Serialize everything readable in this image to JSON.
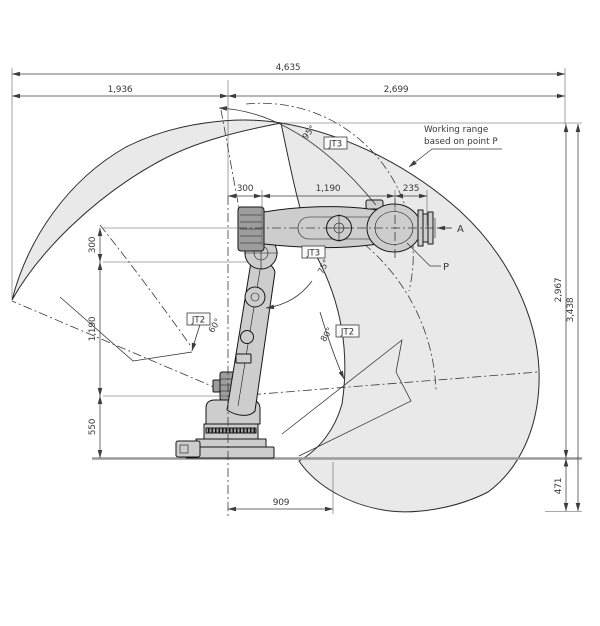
{
  "drawing": {
    "note_line1": "Working range",
    "note_line2": "based on point P",
    "point_a": "A",
    "point_p": "P"
  },
  "joints": {
    "jt3_top": "JT3",
    "jt3_mid": "JT3",
    "jt2_left": "JT2",
    "jt2_right": "JT2"
  },
  "angles": {
    "jt3_top": "95°",
    "jt3_mid": "75°",
    "jt2_left": "60°",
    "jt2_right": "80°"
  },
  "dimensions": {
    "total_width": "4,635",
    "width_left": "1,936",
    "width_right": "2,699",
    "arm_offset": "300",
    "forearm_length": "1,190",
    "wrist_length": "235",
    "shoulder_offset": "300",
    "lower_arm_length": "1,190",
    "base_height": "550",
    "rear_reach": "909",
    "height_above_ground": "2,967",
    "total_height": "3,438",
    "depth_below_ground": "471"
  },
  "colors": {
    "working_range_fill": "#e9e9e9",
    "outline": "#2b2b2b",
    "ground": "#9b9b9b",
    "robot_fill": "#cdcdcd"
  }
}
